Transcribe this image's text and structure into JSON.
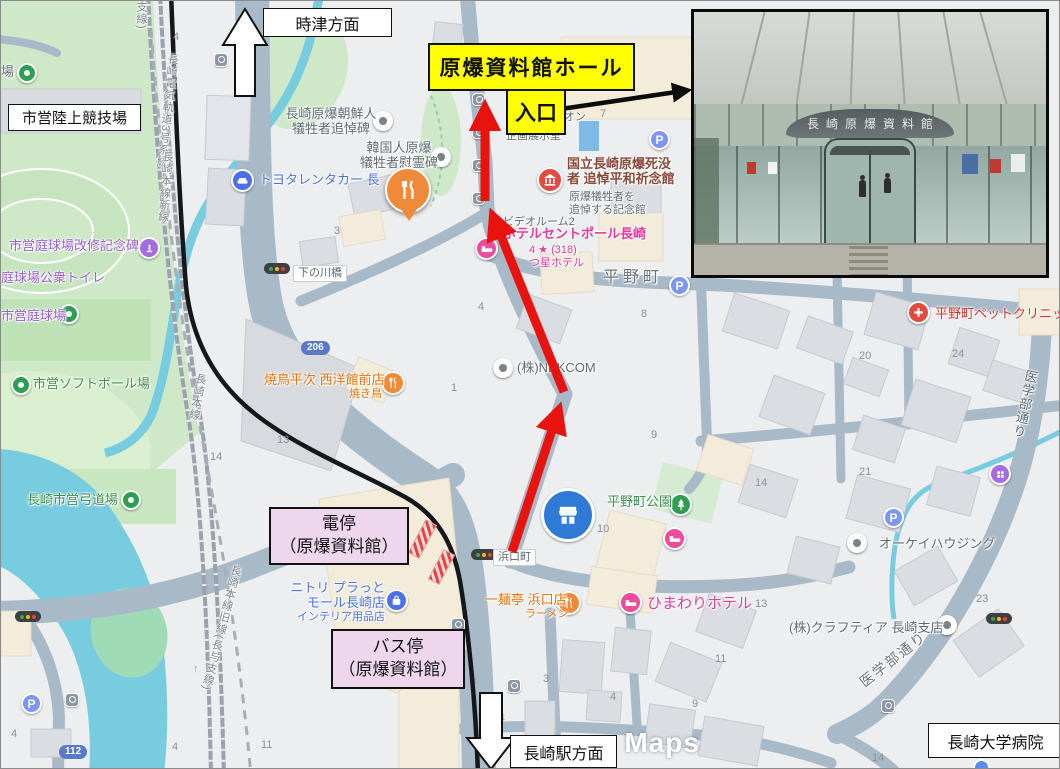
{
  "callouts": {
    "hall": "原爆資料館ホール",
    "entrance": "入口",
    "tram_stop": "電停\n（原爆資料館）",
    "bus_stop": "バス停\n（原爆資料館）",
    "dir_north": "時津方面",
    "dir_south": "長崎駅方面",
    "stadium": "市営陸上競技場",
    "hospital": "長崎大学病院"
  },
  "photo": {
    "building_sign": "長崎原爆資料館"
  },
  "colors": {
    "route_red": "#e8120f",
    "highlight_yellow": "#ffff00",
    "callout_pink": "#eed7ed",
    "lawson_blue": "#3679d3",
    "water": "#77cce0",
    "park_green": "#cfe9c8",
    "road": "#a8b9c8"
  },
  "map": {
    "watermark": "e Maps",
    "oneway": [
      "↑",
      "↓",
      "↑",
      "↓"
    ],
    "route_badges": [
      {
        "label": "206"
      },
      {
        "label": "112"
      }
    ],
    "street_labels": [
      {
        "label": "平野町"
      },
      {
        "label": "浜口町"
      },
      {
        "label": "下の川橋"
      },
      {
        "label": "医学部通り"
      },
      {
        "label": "医学部通り"
      }
    ],
    "rail_labels": [
      {
        "label": "支線)"
      },
      {
        "label": "長崎電気軌道3号系統"
      },
      {
        "label": "長崎本線新線"
      },
      {
        "label": "長崎本線"
      },
      {
        "label": "長崎本線旧線(長与支線)"
      }
    ],
    "lawson": {
      "name": "LAWSON"
    },
    "numbers": [
      "4",
      "6",
      "7",
      "3",
      "8",
      "4",
      "1",
      "13",
      "14",
      "9",
      "10",
      "14",
      "13",
      "20",
      "24",
      "21",
      "23",
      "11",
      "3",
      "4",
      "9",
      "11",
      "4",
      "4",
      "14"
    ],
    "pois": [
      {
        "label": "場"
      },
      {
        "label": "市営庭球場改修記念碑"
      },
      {
        "label": "庭球場公衆トイレ"
      },
      {
        "label": "市営庭球場"
      },
      {
        "label": "市営ソフトボール場"
      },
      {
        "label": "長崎市営弓道場"
      },
      {
        "label": "長崎原爆朝鮮人\n犠牲者追悼碑"
      },
      {
        "label": "韓国人原爆\n犠牲者慰霊碑"
      },
      {
        "label": "トヨタレンタカー 長"
      },
      {
        "label": "寶來軒"
      },
      {
        "label": "焼鳥平次 西洋館前店",
        "sub": "焼き鳥"
      },
      {
        "label": "(株)NEKCOM"
      },
      {
        "label": "国立長崎原爆死没\n者 追悼平和祈念館",
        "sub": "原爆犠牲者を\n追悼する記念館"
      },
      {
        "label": "ホテルセントポール長崎",
        "sub": "4 ★ (318)\nつ星ホテル"
      },
      {
        "label": "ビデオルーム2"
      },
      {
        "label": "企画展示室"
      },
      {
        "label": "オン"
      },
      {
        "label": "平野町ペットクリニック"
      },
      {
        "label": "平野町公園"
      },
      {
        "label": "ひまわりホテル"
      },
      {
        "label": "一麺亭 浜口店",
        "sub": "ラーメン"
      },
      {
        "label": "オーケイハウジング"
      },
      {
        "label": "(株)クラフティア 長崎支店"
      },
      {
        "label": "ニトリ プラっと\nモール長崎店",
        "sub": "インテリア用品店"
      }
    ]
  }
}
